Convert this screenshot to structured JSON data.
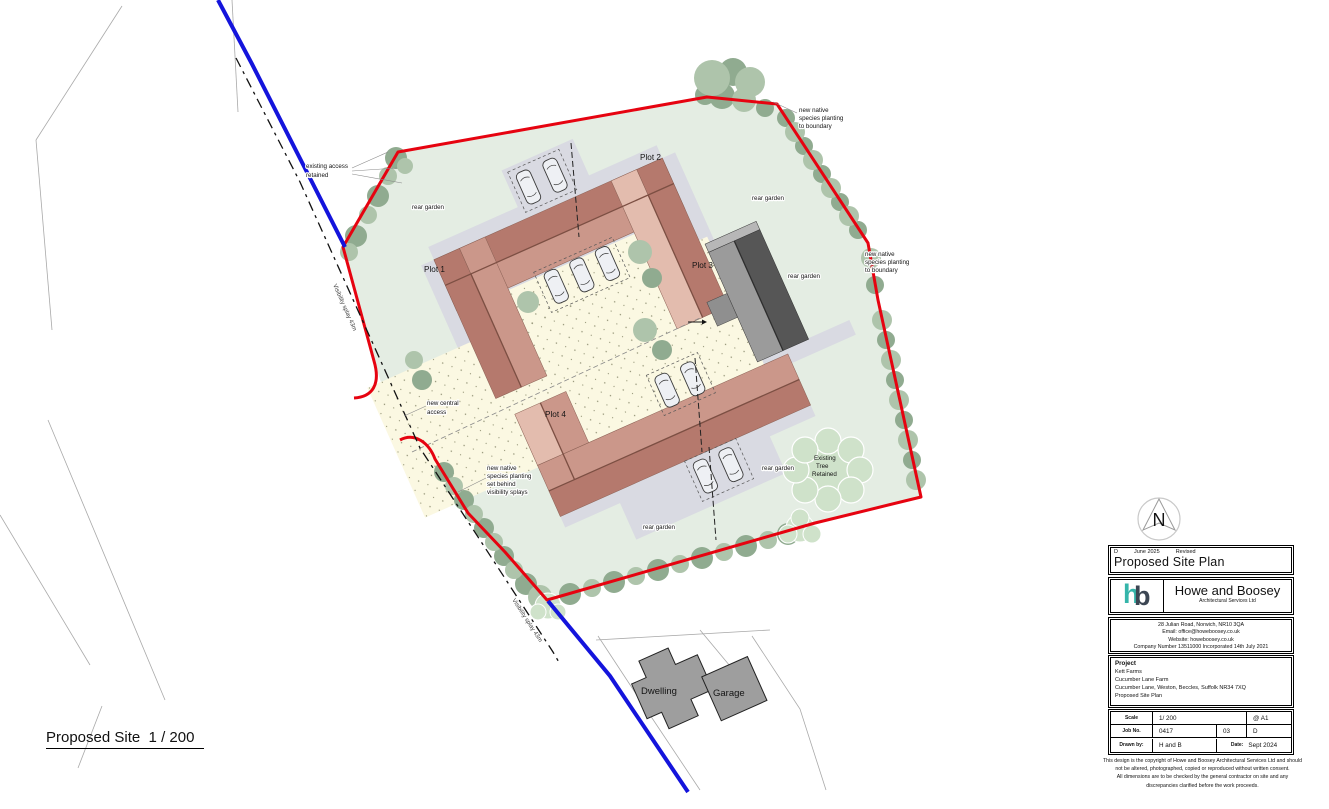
{
  "colors": {
    "boundary_red": "#e60310",
    "road_blue": "#1414dc",
    "site_green": "#e4ede3",
    "courtyard_cream": "#fbf8e2",
    "paving_gray": "#d9dae2",
    "roof_dark": "#b5796d",
    "roof_light": "#cb978a",
    "roof_pale": "#e3bcae",
    "ridge_brown": "#7c4f43",
    "plot3_dark": "#565656",
    "plot3_light": "#9b9b9b",
    "tree_dark": "#90ab90",
    "tree_light": "#aec4ab",
    "existing_tree_green": "#cfe2ca",
    "building_gray": "#9e9e9e",
    "logo_teal": "#35b5aa",
    "logo_navy": "#3c4653"
  },
  "plan": {
    "labels": {
      "existing_access": [
        "existing access",
        "retained"
      ],
      "rear_garden": "rear garden",
      "plot1": "Plot 1",
      "plot2": "Plot 2",
      "plot3": "Plot 3",
      "plot4": "Plot 4",
      "new_central_access": [
        "new central",
        "access"
      ],
      "planting_splays": [
        "new native",
        "species planting",
        "set behind",
        "visibility splays"
      ],
      "planting_boundary": [
        "new native",
        "species planting",
        "to boundary"
      ],
      "existing_tree": [
        "Existing",
        "Tree",
        "Retained"
      ],
      "visibility_splay": "Visibility splay 43m",
      "dwelling": "Dwelling",
      "garage": "Garage"
    },
    "sheet_caption": "Proposed Site  1 / 200",
    "north_letter": "N"
  },
  "title_block": {
    "revision": {
      "letter": "D",
      "date": "June 2025",
      "status": "Revised"
    },
    "drawing_title": "Proposed Site Plan",
    "company": {
      "logo_h": "h",
      "logo_b": "b",
      "name": "Howe and Boosey",
      "subtitle": "Architectural Services Ltd"
    },
    "contact": {
      "address": "28 Julian Road, Norwich, NR10 3QA",
      "email": "Email: office@howeboosey.co.uk",
      "website": "Website: howeboosey.co.uk",
      "company_number": "Company Number 13511000 Incorporated 14th July 2021"
    },
    "project": {
      "heading": "Project",
      "lines": [
        "Kett Farms",
        "Cucumber Lane Farm",
        "Cucumber Lane, Weston, Beccles, Suffolk NR34 7XQ",
        "Proposed Site Plan"
      ]
    },
    "info_table": {
      "scale_label": "Scale",
      "scale_value": "1/ 200",
      "sheet_size": "@ A1",
      "job_label": "Job No.",
      "job_value": "0417",
      "revision_number": "03",
      "revision_letter": "D",
      "drawn_label": "Drawn by:",
      "drawn_value": "H and B",
      "date_label": "Date:",
      "date_value": "Sept 2024"
    },
    "copyright": [
      "This design is the copyright of Howe and Boosey Architectural Services Ltd and should",
      "not be altered, photographed, copied or reproduced without written consent.",
      "All dimensions are to be checked by the general contractor on site and any",
      "discrepancies clarified before the work proceeds."
    ]
  }
}
